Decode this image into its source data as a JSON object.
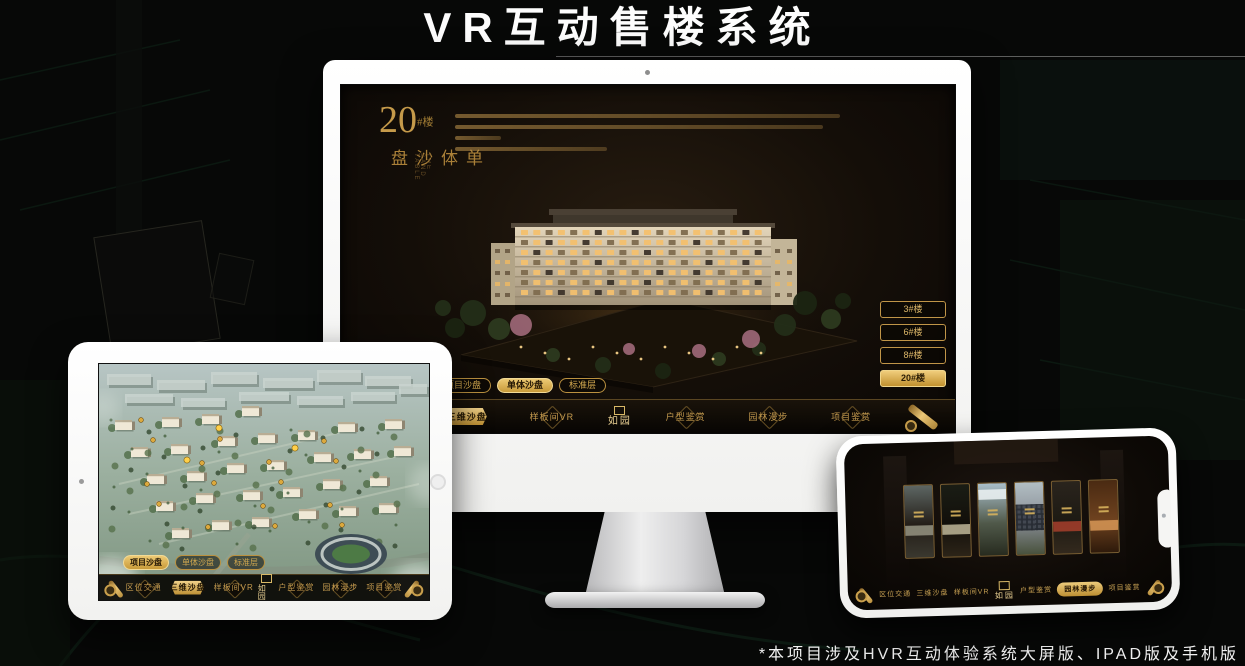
{
  "page": {
    "title": "VR互动售楼系统",
    "footnote": "*本项目涉及HVR互动体验系统大屏版、IPAD版及手机版"
  },
  "colors": {
    "gold": "#c9a44c",
    "gold_bright": "#ecc979",
    "gold_deep": "#8a6a2f",
    "screen_bg": "#14100a"
  },
  "sandbox_ui": {
    "tabs": [
      {
        "label": "项目沙盘"
      },
      {
        "label": "单体沙盘"
      },
      {
        "label": "标准层"
      }
    ],
    "nav": {
      "items": [
        "区位交通",
        "三维沙盘",
        "样板间VR",
        "户型鉴赏",
        "园林漫步",
        "项目鉴赏"
      ],
      "logo": "如园"
    }
  },
  "monitor": {
    "title_block": {
      "number": "20",
      "suffix": "#楼",
      "vertical": "单体沙盘",
      "caption": "THE SAND TABLE"
    },
    "building_buttons": [
      {
        "label": "3#楼",
        "active": false
      },
      {
        "label": "6#楼",
        "active": false
      },
      {
        "label": "8#楼",
        "active": false
      },
      {
        "label": "20#楼",
        "active": true
      }
    ],
    "active_tab": "单体沙盘",
    "active_nav": "三维沙盘"
  },
  "tablet": {
    "active_tab": "项目沙盘",
    "active_nav": "三维沙盘"
  },
  "phone": {
    "active_nav": "园林漫步",
    "panels": [
      {
        "top": "#5d6663",
        "mid": "#231d17",
        "bottom": "#3a382f",
        "accent": "#8f8d7c",
        "kind": "arch"
      },
      {
        "top": "#1a1d15",
        "mid": "#120f0a",
        "bottom": "#2c2418",
        "accent": "#b5ad90",
        "kind": "band"
      },
      {
        "top": "#a9bec9",
        "mid": "#50594a",
        "bottom": "#272b1f",
        "accent": "#e8eef0",
        "kind": "sky"
      },
      {
        "top": "#b2bec3",
        "mid": "#878c94",
        "bottom": "#48513c",
        "accent": "#3c414b",
        "kind": "windows"
      },
      {
        "top": "#2a241d",
        "mid": "#1d1a13",
        "bottom": "#33291d",
        "accent": "#a03d2a",
        "kind": "lantern"
      },
      {
        "top": "#4a2a12",
        "mid": "#6e421f",
        "bottom": "#2e1a0b",
        "accent": "#d29253",
        "kind": "shelves"
      }
    ]
  }
}
